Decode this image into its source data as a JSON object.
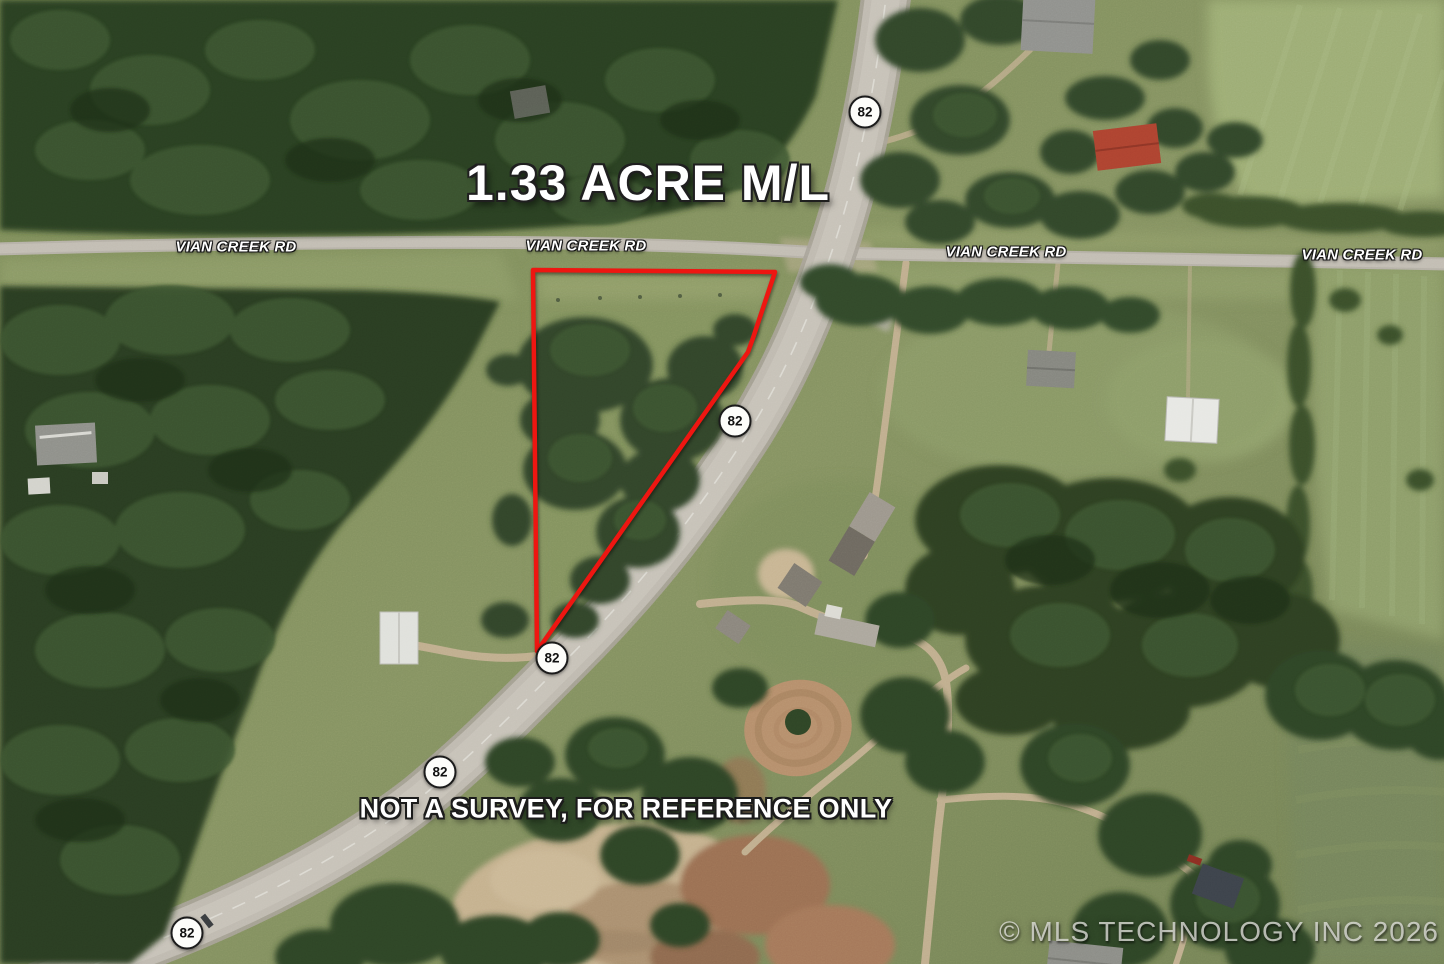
{
  "map": {
    "title": "1.33 ACRE M/L",
    "disclaimer": "NOT A SURVEY, FOR REFERENCE ONLY",
    "copyright": "© MLS TECHNOLOGY INC 2026",
    "road_name": "VIAN CREEK RD",
    "highway_route": "82",
    "road_labels": [
      {
        "text": "VIAN CREEK RD",
        "x": 236,
        "y": 247
      },
      {
        "text": "VIAN CREEK RD",
        "x": 586,
        "y": 246
      },
      {
        "text": "VIAN CREEK RD",
        "x": 1006,
        "y": 252
      },
      {
        "text": "VIAN CREEK RD",
        "x": 1362,
        "y": 255
      }
    ],
    "highway_shields": [
      {
        "route": "82",
        "x": 865,
        "y": 112
      },
      {
        "route": "82",
        "x": 735,
        "y": 421
      },
      {
        "route": "82",
        "x": 552,
        "y": 658
      },
      {
        "route": "82",
        "x": 440,
        "y": 772
      },
      {
        "route": "82",
        "x": 187,
        "y": 933
      }
    ],
    "shield_style": {
      "fill": "#fdfdfa",
      "border": "#1b1b1b",
      "text_color": "#111111"
    },
    "parcel": {
      "outline_color": "#ee1510",
      "points": "533,270 775,272 753,338 748,352 537,651"
    },
    "title_pos": {
      "x": 466,
      "y": 154
    },
    "disclaimer_pos": {
      "x": 626,
      "y": 809
    }
  }
}
